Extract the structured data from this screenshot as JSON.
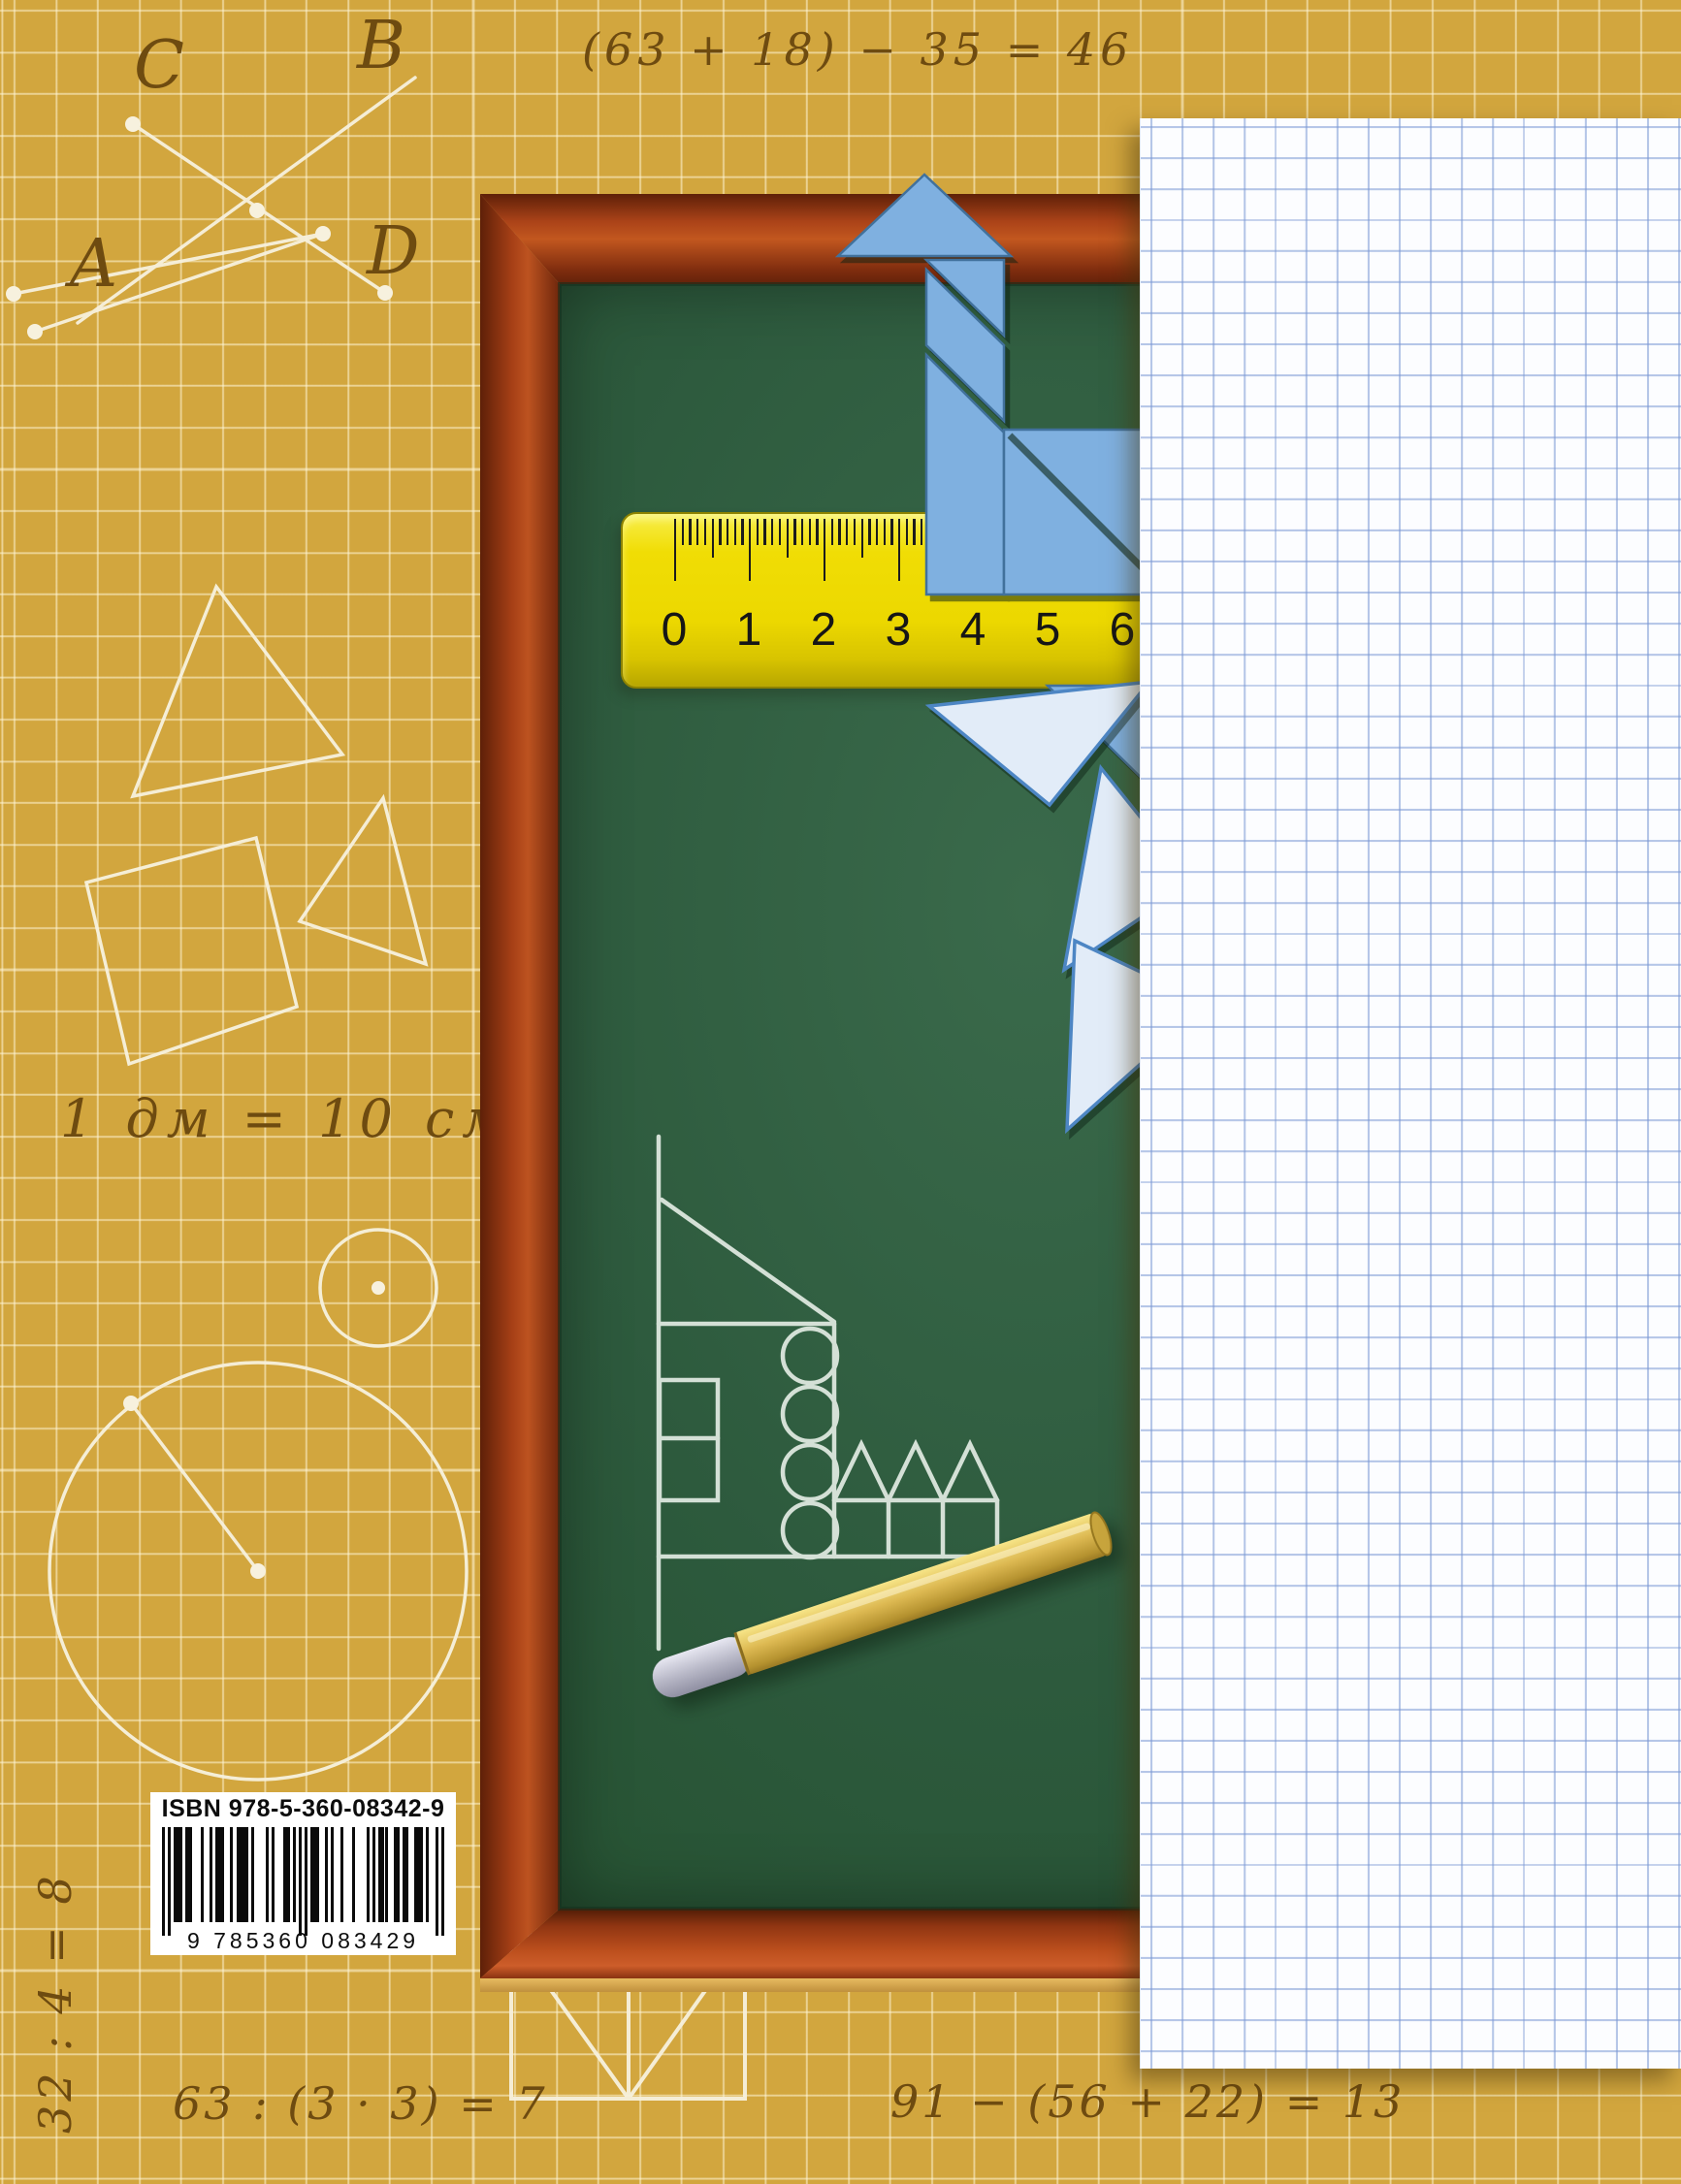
{
  "cover": {
    "title_hint": "math textbook back cover",
    "background_color": "#d2a63e",
    "grid_line_color": "#fff7da",
    "handwriting_color": "#6e4b10",
    "annotations": {
      "eq_top": "(63 + 18) − 35 = 46",
      "eq_dm": "1 дм = 10 см",
      "eq_div": "63 : (3 · 3) = 7",
      "eq_sub": "91 − (56 + 22) = 13",
      "eq_side": "32 : 4 = 8"
    },
    "point_labels": {
      "c": "C",
      "b": "B",
      "a": "A",
      "d": "D"
    }
  },
  "chalkboard": {
    "board_color": "#2d5a3d",
    "frame_color": "#b04a1d",
    "chalk_color": "#e6efe7"
  },
  "ruler": {
    "color": "#ecd800",
    "unit_numbers": [
      "0",
      "1",
      "2",
      "3",
      "4",
      "5",
      "6"
    ]
  },
  "tangram": {
    "piece_color": "#7fb0e0",
    "pale_piece_color": "#e2ecf8"
  },
  "paper": {
    "color": "#fcfdff",
    "grid_color": "#7a98d4"
  },
  "barcode": {
    "isbn_label": "ISBN 978-5-360-08342-9",
    "digits": "9 785360 083429",
    "pattern": "1010111011000100101110010111101000010100011010101011100101001000100001010111001101100111010 0101",
    "ean_pattern": "10101110110001001011100101111010000101000110101010111100101001000100001010111001101100111010 0101"
  }
}
